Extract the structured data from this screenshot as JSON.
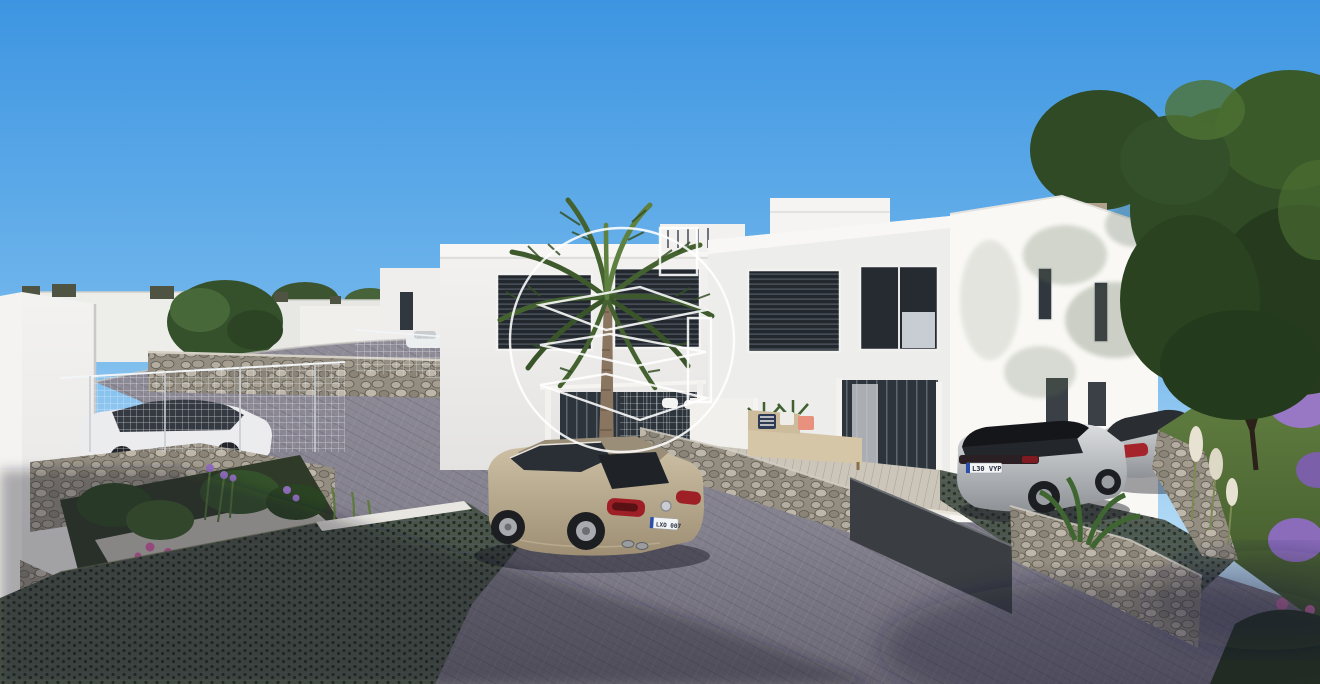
{
  "scene": {
    "alt": "3D architectural render: street view of a modern development of white two-storey villas with dark louvered windows, gabion stone walls, wire-mesh fences, a tall palm tree, parked cars and a white circular watermark logo in the centre",
    "watermark": {
      "name": "developer-logo-watermark",
      "style": "white outline circle with stylized 3 glyph and square",
      "color": "#ffffff"
    }
  },
  "vehicles": {
    "sedan": {
      "label": "champagne sedan on street",
      "plate": "LXO 007"
    },
    "suv": {
      "label": "silver SUV in driveway",
      "plate": "L30 VYP"
    },
    "coupe": {
      "label": "silver coupe in driveway"
    },
    "compact": {
      "label": "white compact car behind fence"
    }
  },
  "palette": {
    "sky_top": "#3d95e1",
    "sky_horizon": "#ddf0fb",
    "building_white": "#f1f0ee",
    "building_sunlit": "#f9f8f5",
    "louver_dark": "#23282e",
    "glass_dark": "#2e343c",
    "road_gray": "#908d99",
    "road_shadow": "#5e5b68",
    "gabion_stone": "#948e82",
    "grass_green": "#55743b",
    "tree_green": "#2f4a24",
    "palm_green": "#44622f",
    "sedan_champagne": "#c0b196",
    "car_silver": "#c3c4c6",
    "taillight_red": "#9e1f26",
    "fence_dark": "#3a3e42",
    "deck_wood": "#ccc5b9",
    "flower_purple": "#8e6cbb",
    "flower_pink": "#d060a5",
    "watermark_white": "#ffffff"
  }
}
